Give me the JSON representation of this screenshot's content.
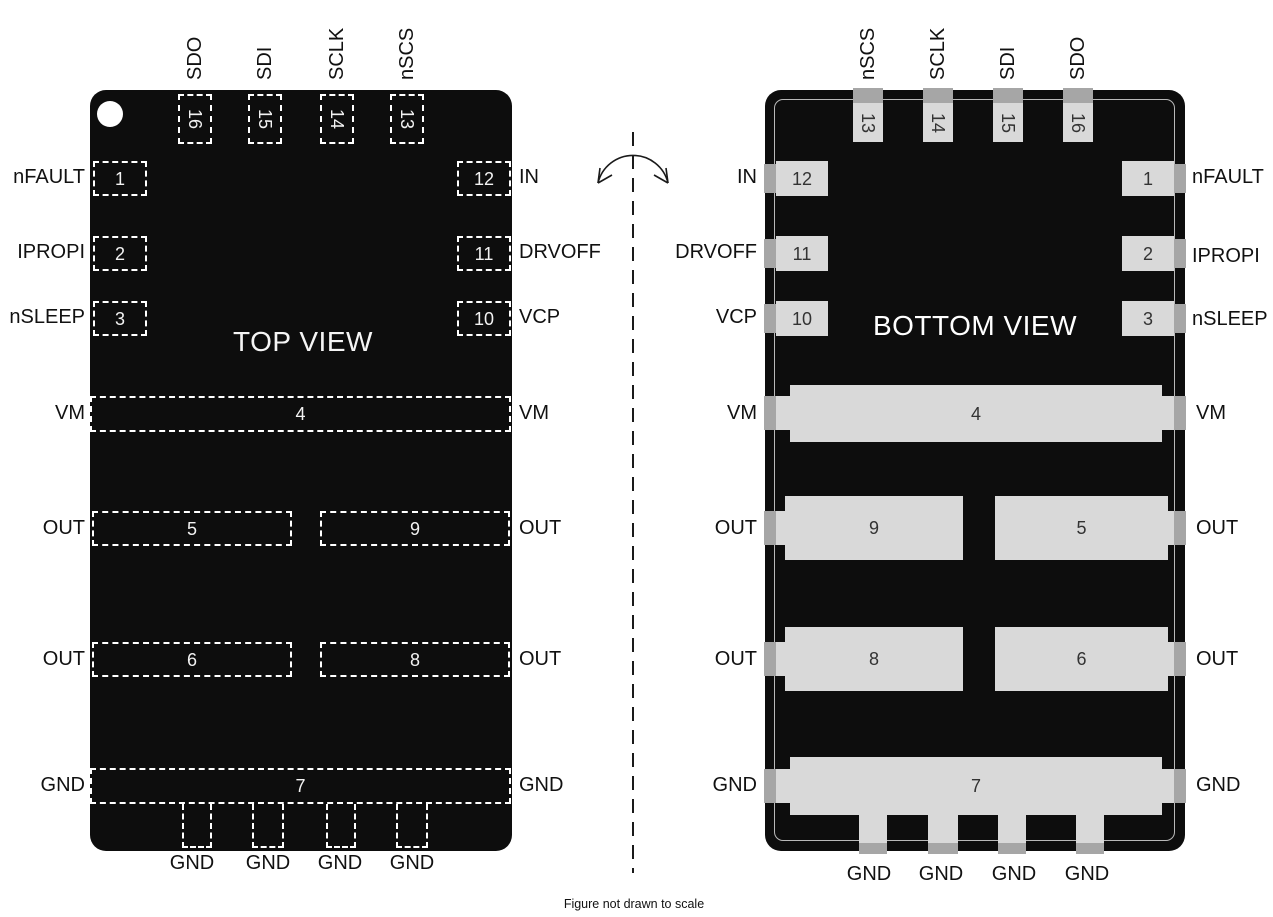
{
  "figure": {
    "caption": "Figure not drawn to scale",
    "flip_icon": "flip-horizontal-axis-icon"
  },
  "colors": {
    "package_body": "#0d0d0d",
    "pad_gray": "#d9d9d9",
    "edge_tab_gray": "#a6a6a6",
    "dashed_outline": "#ffffff",
    "label_text": "#111111",
    "view_title_text": "#f5f5f5"
  },
  "top_view": {
    "title": "TOP VIEW",
    "top_pins": [
      {
        "num": "16",
        "label": "SDO"
      },
      {
        "num": "15",
        "label": "SDI"
      },
      {
        "num": "14",
        "label": "SCLK"
      },
      {
        "num": "13",
        "label": "nSCS"
      }
    ],
    "left_pins": [
      {
        "num": "1",
        "label": "nFAULT"
      },
      {
        "num": "2",
        "label": "IPROPI"
      },
      {
        "num": "3",
        "label": "nSLEEP"
      }
    ],
    "right_pins": [
      {
        "num": "12",
        "label": "IN"
      },
      {
        "num": "11",
        "label": "DRVOFF"
      },
      {
        "num": "10",
        "label": "VCP"
      }
    ],
    "vm_pin": {
      "num": "4",
      "left_label": "VM",
      "right_label": "VM"
    },
    "out_row_1": {
      "left": {
        "num": "5"
      },
      "right": {
        "num": "9"
      },
      "left_label": "OUT",
      "right_label": "OUT"
    },
    "out_row_2": {
      "left": {
        "num": "6"
      },
      "right": {
        "num": "8"
      },
      "left_label": "OUT",
      "right_label": "OUT"
    },
    "gnd_pin": {
      "num": "7",
      "left_label": "GND",
      "right_label": "GND"
    },
    "bottom_gnd_labels": [
      "GND",
      "GND",
      "GND",
      "GND"
    ]
  },
  "bottom_view": {
    "title": "BOTTOM VIEW",
    "top_pins": [
      {
        "num": "13",
        "label": "nSCS"
      },
      {
        "num": "14",
        "label": "SCLK"
      },
      {
        "num": "15",
        "label": "SDI"
      },
      {
        "num": "16",
        "label": "SDO"
      }
    ],
    "left_pins": [
      {
        "num": "12",
        "label": "IN"
      },
      {
        "num": "11",
        "label": "DRVOFF"
      },
      {
        "num": "10",
        "label": "VCP"
      }
    ],
    "right_pins": [
      {
        "num": "1",
        "label": "nFAULT"
      },
      {
        "num": "2",
        "label": "IPROPI"
      },
      {
        "num": "3",
        "label": "nSLEEP"
      }
    ],
    "vm_pin": {
      "num": "4",
      "left_label": "VM",
      "right_label": "VM"
    },
    "out_row_1": {
      "left": {
        "num": "9"
      },
      "right": {
        "num": "5"
      },
      "left_label": "OUT",
      "right_label": "OUT"
    },
    "out_row_2": {
      "left": {
        "num": "8"
      },
      "right": {
        "num": "6"
      },
      "left_label": "OUT",
      "right_label": "OUT"
    },
    "gnd_pin": {
      "num": "7",
      "left_label": "GND",
      "right_label": "GND"
    },
    "bottom_gnd_labels": [
      "GND",
      "GND",
      "GND",
      "GND"
    ]
  }
}
